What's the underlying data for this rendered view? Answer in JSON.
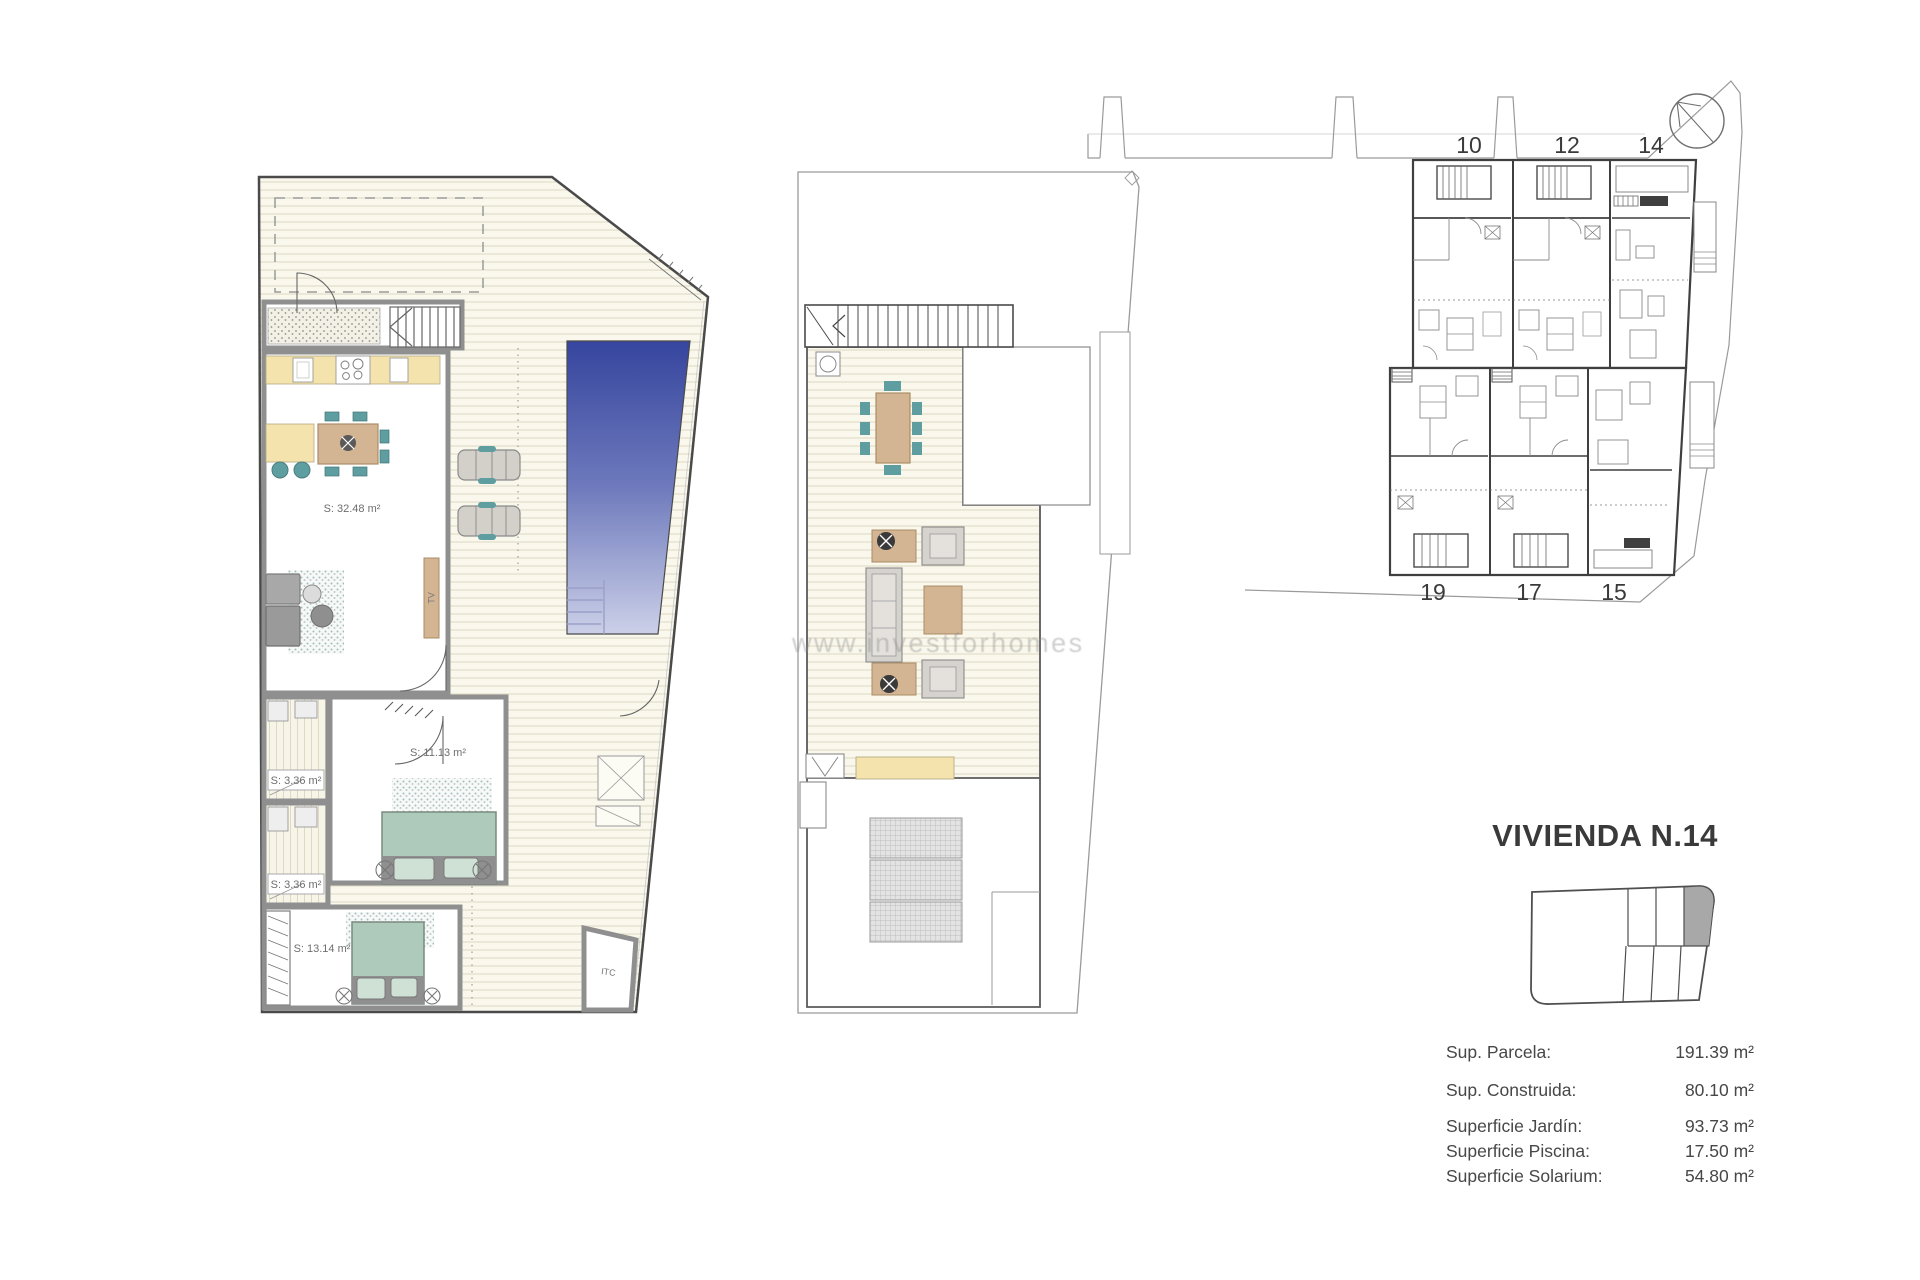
{
  "ground_floor": {
    "labels": {
      "living": "S: 32.48 m²",
      "bedroom1": "S: 11.13 m²",
      "bath1": "S: 3.36 m²",
      "bath2": "S: 3.36 m²",
      "bedroom2": "S: 13.14 m²",
      "itc": "ITC",
      "tv": "TV"
    }
  },
  "watermark": {
    "text": "www.investforhomes"
  },
  "site_plan": {
    "units_top": [
      "10",
      "12",
      "14"
    ],
    "units_bottom": [
      "19",
      "17",
      "15"
    ]
  },
  "info_panel": {
    "title": "VIVIENDA N.14",
    "specs": [
      {
        "label": "Sup. Parcela:",
        "value": "191.39 m²"
      },
      {
        "label": "Sup. Construida:",
        "value": "80.10 m²"
      },
      {
        "label": "Superficie Jardín:",
        "value": "93.73 m²"
      },
      {
        "label": "Superficie Piscina:",
        "value": "17.50 m²"
      },
      {
        "label": "Superficie Solarium:",
        "value": "54.80 m²"
      }
    ]
  },
  "colors": {
    "pool_top": "#36459e",
    "pool_bottom": "#ccd0e8",
    "teal": "#5f9ea0",
    "furniture_tan": "#d3b493",
    "bed_green": "#aecabb",
    "counter_yellow": "#f5e3ad",
    "unit_highlight": "#a8a8a8"
  }
}
